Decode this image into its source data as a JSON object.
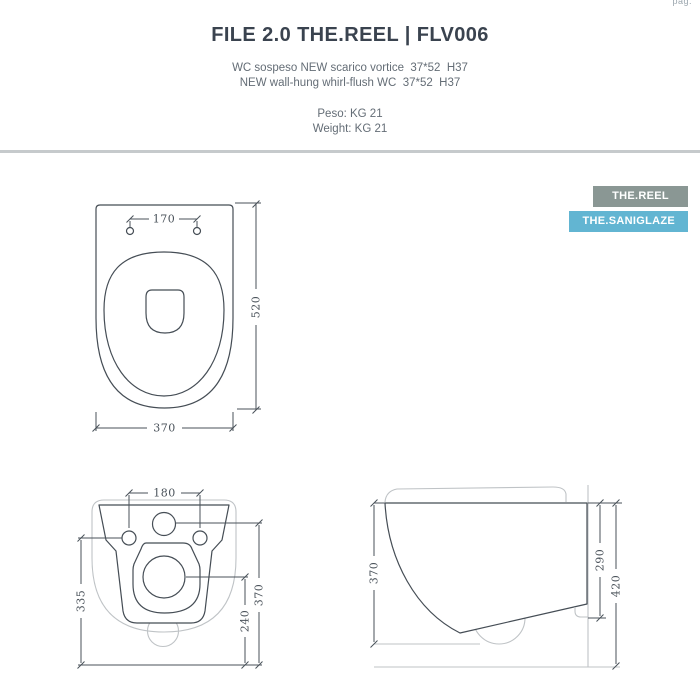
{
  "page": {
    "corner_note": "pag."
  },
  "header": {
    "title": "FILE 2.0 THE.REEL | FLV006",
    "subtitle_line1": "WC sospeso NEW scarico vortice  37*52  H37",
    "subtitle_line2": "NEW wall-hung whirl-flush WC  37*52  H37",
    "weight_line1": "Peso: KG 21",
    "weight_line2": "Weight: KG 21"
  },
  "badges": {
    "reel": {
      "label": "THE.REEL",
      "bg": "#8A9794"
    },
    "saniglaze": {
      "label": "THE.SANIGLAZE",
      "bg": "#62B5D2"
    }
  },
  "drawings": {
    "top_view": {
      "hole_spacing_mm": "170",
      "depth_mm": "520",
      "width_mm": "370"
    },
    "front_view": {
      "hole_spacing_mm": "180",
      "left_height_mm": "335",
      "right_height_mm": "370",
      "drain_center_mm": "240"
    },
    "side_view": {
      "depth_mm": "370",
      "outlet_height_mm": "290",
      "total_height_mm": "420"
    }
  },
  "colors": {
    "line_dark": "#454D55",
    "line_light": "#BFC3C6",
    "text_dark": "#3A434F",
    "text_muted": "#646D76",
    "divider": "#C6CACC",
    "badge_reel_bg": "#8A9794",
    "badge_saniglaze_bg": "#62B5D2"
  }
}
